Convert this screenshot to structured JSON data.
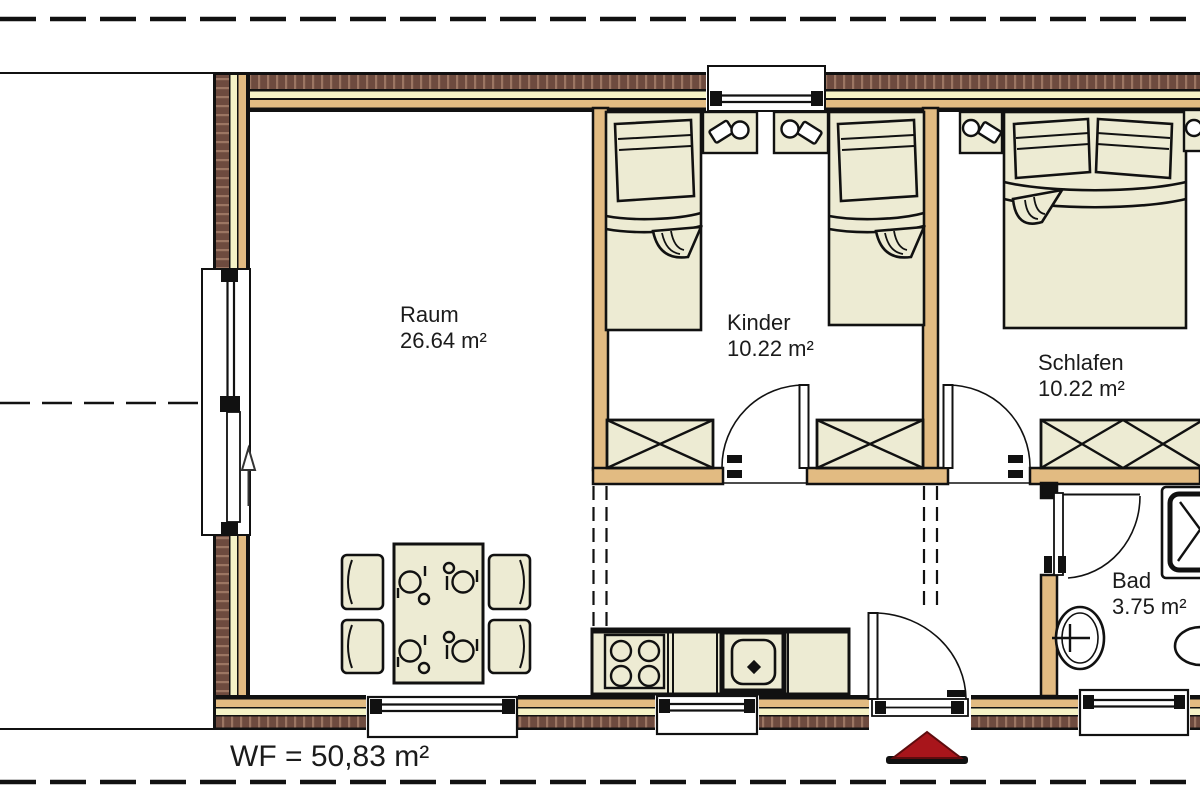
{
  "plan": {
    "title": "Wohnung Grundriss",
    "rooms": [
      {
        "name": "Raum",
        "area": "26.64 m²"
      },
      {
        "name": "Kinder",
        "area": "10.22 m²"
      },
      {
        "name": "Schlafen",
        "area": "10.22 m²"
      },
      {
        "name": "Bad",
        "area": "3.75 m²"
      }
    ],
    "footer": {
      "living_area_label": "WF = 50,83 m²"
    },
    "furniture": [
      "single-bed",
      "single-bed",
      "double-bed",
      "nightstand",
      "wardrobe",
      "dining-table",
      "chairs",
      "stove",
      "sink",
      "washbasin",
      "shower",
      "wc"
    ],
    "icons": [
      "entrance-marker-icon",
      "direction-arrow-icon"
    ],
    "colors": {
      "wall_wood": "#E2BB82",
      "insulation": "#F5F2C6",
      "brick": "#6E4B3F",
      "brick_hatch": "#9C7663",
      "furniture_fill": "#EDEBD3",
      "entrance_marker_red": "#A8151B",
      "line": "#111111"
    }
  }
}
